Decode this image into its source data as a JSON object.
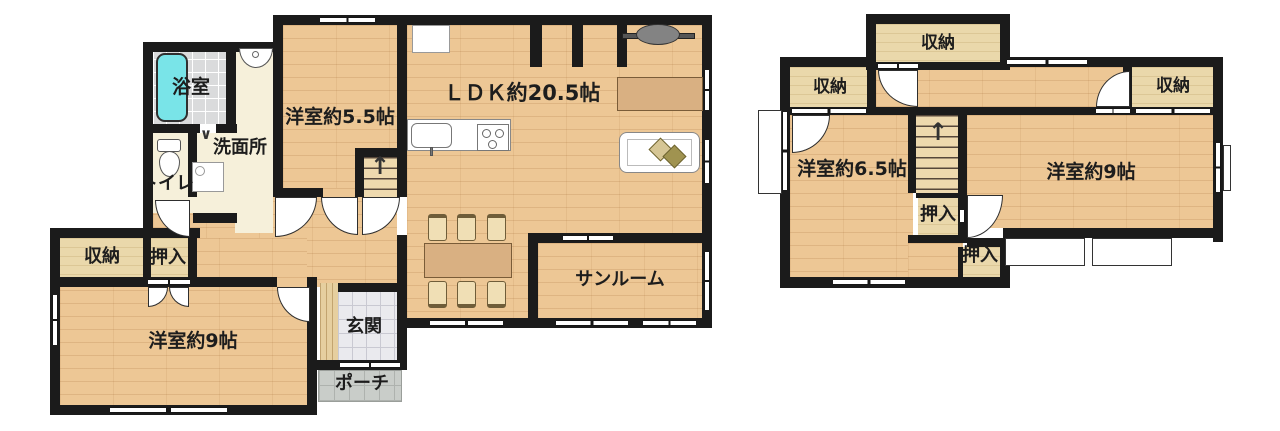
{
  "floor1": {
    "bath": "浴室",
    "washroom": "洗面所",
    "toilet": "トイレ",
    "bedroom_5_5": "洋室約5.5帖",
    "ldk": "ＬＤＫ約20.5帖",
    "sunroom": "サンルーム",
    "storage": "収納",
    "oshiire": "押入",
    "bedroom_9": "洋室約9帖",
    "entrance": "玄関",
    "porch": "ポーチ",
    "stairs_arrow": "↑"
  },
  "floor2": {
    "storage_top": "収納",
    "storage_left": "収納",
    "storage_right": "収納",
    "bedroom_6_5": "洋室約6.5帖",
    "bedroom_9": "洋室約9帖",
    "oshiire_upper": "押入",
    "oshiire_lower": "押入",
    "stairs_arrow": "↑"
  },
  "colors": {
    "wall": "#1b1b1b",
    "wood_floor": "#edc795",
    "closet_floor": "#ead8ab",
    "sanitary_floor": "#f6f0da",
    "bath_tile": "#dadbdc",
    "bathtub": "#79e4e8",
    "entrance_tile": "#eaeaee",
    "porch_tile": "#c9cdc9",
    "furniture_wood": "#d9b082",
    "background": "#ffffff"
  }
}
